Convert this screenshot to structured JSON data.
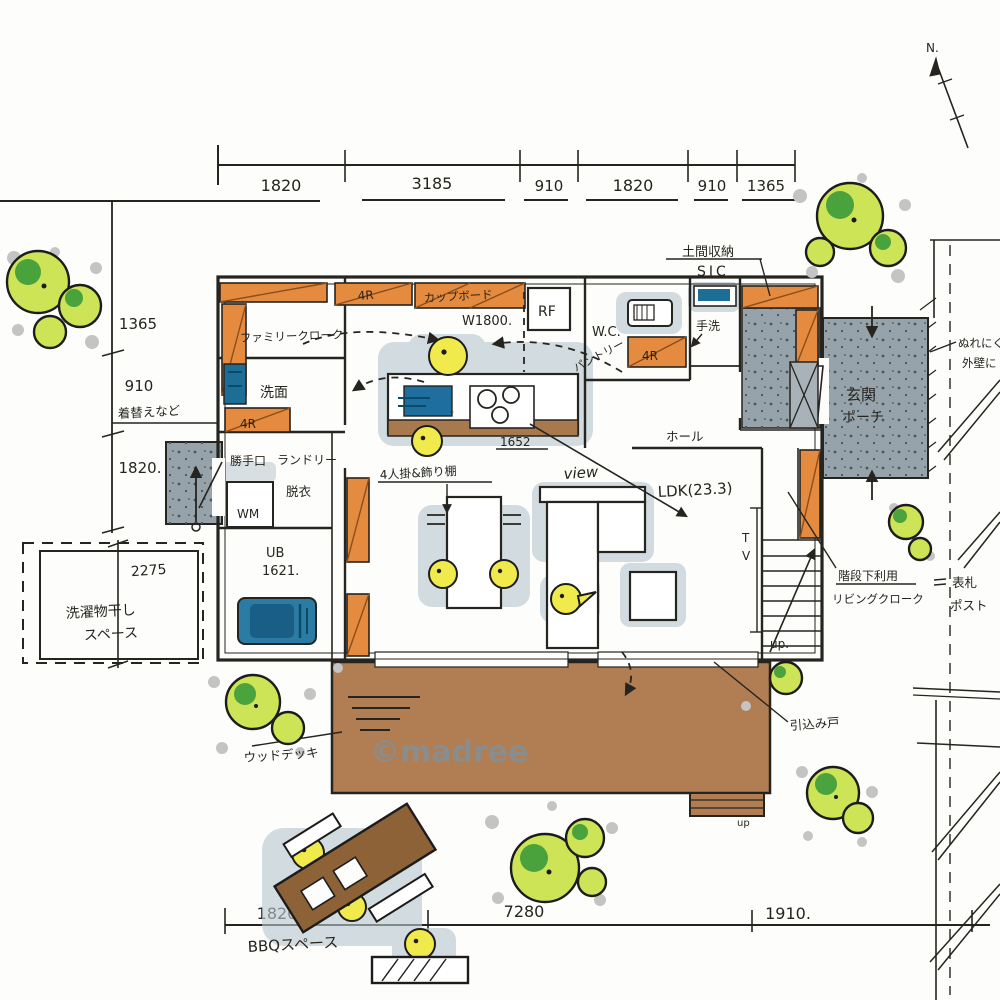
{
  "watermark": "©madree",
  "compass": {
    "north": "N."
  },
  "dims": {
    "top": [
      "1820",
      "3185",
      "910",
      "1820",
      "910",
      "1365"
    ],
    "left": [
      "1365",
      "910",
      "1820."
    ],
    "left_lower": "2275",
    "bottom": [
      "1820",
      "7280",
      "1910."
    ]
  },
  "labels": {
    "doma_storage": "土間収納",
    "sic": "SIC",
    "tearai": "手洗",
    "wc": "W.C.",
    "rf": "RF",
    "cupboard": "カップボード",
    "cupboard_w": "W1800.",
    "closet_top": "4R",
    "closet_wc": "4R",
    "closet_wash": "4R",
    "family_closet": "ファミリークローク",
    "washroom": "洗面",
    "changing": "着替えなど",
    "backdoor": "勝手口",
    "laundry": "ランドリー",
    "undressing": "脱衣",
    "wm": "WM",
    "bath": "UB",
    "bath_size": "1621.",
    "drying1": "洗濯物干し",
    "drying2": "スペース",
    "pantry": "パントリー",
    "dining_note": "4人掛&飾り棚",
    "counter_note": "1652",
    "view": "view",
    "ldk": "LDK(23.3)",
    "hall": "ホール",
    "tv1": "T",
    "tv2": "V",
    "up_stairs": "up.",
    "up_deck": "up",
    "genkan1": "玄関",
    "genkan2": "ポーチ",
    "stair_note1": "階段下利用",
    "stair_note2": "リビングクローク",
    "sliding": "引込み戸",
    "nameplate": "表札",
    "post": "ポスト",
    "wet1": "ぬれにく",
    "wet2": "外壁に",
    "deck": "ウッドデッキ",
    "bbq": "BBQスペース"
  }
}
